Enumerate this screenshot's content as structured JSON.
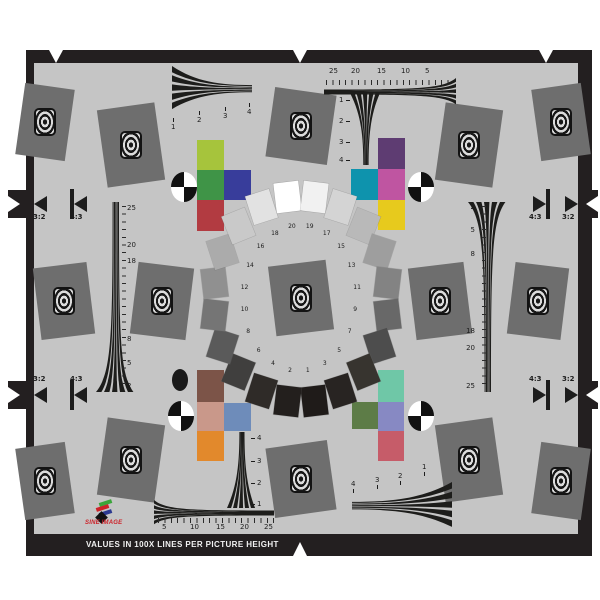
{
  "title_bar": {
    "text": "VALUES IN 100X LINES PER PICTURE HEIGHT"
  },
  "logo": {
    "text": "SINE IMAGE",
    "bar_colors": [
      "#3aa53a",
      "#cc2229",
      "#2b3990"
    ],
    "diamond_color": "#111111"
  },
  "background": {
    "page": "#ffffff",
    "chart": "#c5c5c5",
    "frame": "#231f20",
    "square": "#6e6e6e"
  },
  "aspect_markers": {
    "labels": [
      "3:2",
      "4:3"
    ]
  },
  "rulers": {
    "top": [
      "25",
      "20",
      "15",
      "10",
      "5"
    ],
    "bottom": [
      "5",
      "10",
      "15",
      "20",
      "25"
    ],
    "left": [
      "25",
      "20",
      "18",
      "8",
      "5",
      "2"
    ],
    "right": [
      "2",
      "5",
      "8",
      "18",
      "20",
      "25"
    ]
  },
  "wedges": {
    "top_left": [
      "1",
      "2",
      "3",
      "4"
    ],
    "top_right": [
      "1",
      "2",
      "3",
      "4"
    ],
    "bottom_left": [
      "4",
      "3",
      "2",
      "1"
    ],
    "bottom_right": [
      "4",
      "3",
      "2",
      "1"
    ]
  },
  "grayscale_ring": [
    {
      "n": 20,
      "hex": "#ffffff"
    },
    {
      "n": 19,
      "hex": "#f1f1f1"
    },
    {
      "n": 18,
      "hex": "#e2e2e2"
    },
    {
      "n": 17,
      "hex": "#d4d4d4"
    },
    {
      "n": 16,
      "hex": "#c9c9c9"
    },
    {
      "n": 15,
      "hex": "#b9b9b9"
    },
    {
      "n": 14,
      "hex": "#ababab"
    },
    {
      "n": 13,
      "hex": "#9e9e9e"
    },
    {
      "n": 12,
      "hex": "#909090"
    },
    {
      "n": 11,
      "hex": "#838383"
    },
    {
      "n": 10,
      "hex": "#757575"
    },
    {
      "n": 9,
      "hex": "#686868"
    },
    {
      "n": 8,
      "hex": "#5a5a5a"
    },
    {
      "n": 7,
      "hex": "#4d4d4d"
    },
    {
      "n": 6,
      "hex": "#403f3e"
    },
    {
      "n": 5,
      "hex": "#37342f"
    },
    {
      "n": 4,
      "hex": "#2f2b28"
    },
    {
      "n": 3,
      "hex": "#282422"
    },
    {
      "n": 2,
      "hex": "#231f1d"
    },
    {
      "n": 1,
      "hex": "#1f1b19"
    }
  ],
  "color_patches": {
    "top_left": [
      {
        "name": "yellow-green",
        "hex": "#a6c43c"
      },
      {
        "name": "green",
        "hex": "#3f9447"
      },
      {
        "name": "blue",
        "hex": "#383d9b"
      },
      {
        "name": "red",
        "hex": "#b23b41"
      }
    ],
    "top_right": [
      {
        "name": "purple",
        "hex": "#5e3c72"
      },
      {
        "name": "teal",
        "hex": "#0e93ad"
      },
      {
        "name": "magenta",
        "hex": "#bf55a1"
      },
      {
        "name": "yellow",
        "hex": "#e7ca1d"
      }
    ],
    "bottom_left": [
      {
        "name": "brown",
        "hex": "#7c5448"
      },
      {
        "name": "salmon",
        "hex": "#c9988a"
      },
      {
        "name": "steel-blue",
        "hex": "#6e8cba"
      },
      {
        "name": "orange",
        "hex": "#e2892c"
      }
    ],
    "bottom_right": [
      {
        "name": "mint",
        "hex": "#6fc7a7"
      },
      {
        "name": "olive",
        "hex": "#5d7c47"
      },
      {
        "name": "lavender",
        "hex": "#8789c3"
      },
      {
        "name": "rose",
        "hex": "#c65c69"
      }
    ]
  }
}
